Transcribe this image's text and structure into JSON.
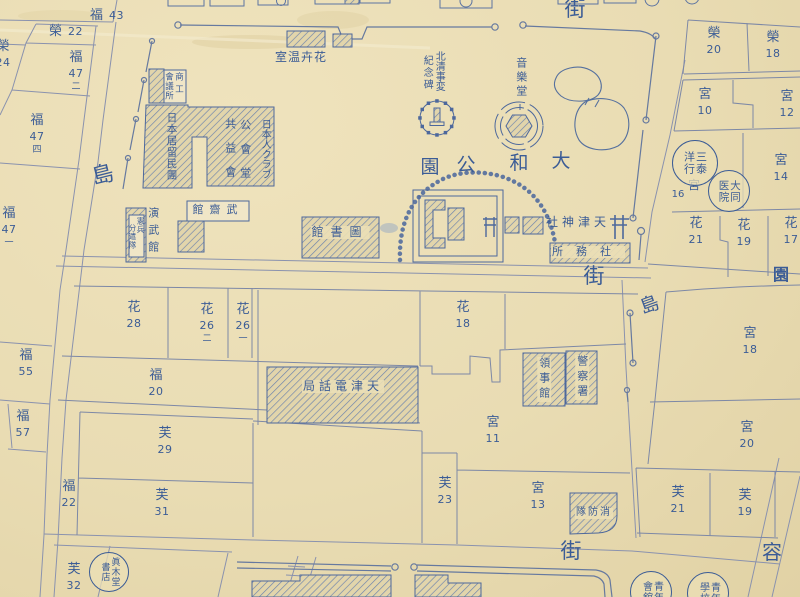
{
  "palette": {
    "paper": "#e9dcb3",
    "ink": "#3b5c96",
    "street_line": "#8a92ae",
    "block_line": "#7d88a6",
    "hatch": "#6b82ad"
  },
  "map": {
    "labels": [
      {
        "name": "street-gai-top",
        "text": "街",
        "x": 575,
        "y": -2,
        "size": 21
      },
      {
        "name": "street-shima-left",
        "text": "島",
        "x": 103,
        "y": 164,
        "size": 22,
        "rot": -14
      },
      {
        "name": "street-gai-middle",
        "text": "街",
        "x": 594,
        "y": 265,
        "size": 21
      },
      {
        "name": "street-shima-right",
        "text": "島",
        "x": 650,
        "y": 296,
        "size": 19,
        "rot": -20
      },
      {
        "name": "street-gai-bottom",
        "text": "街",
        "x": 571,
        "y": 540,
        "size": 21
      },
      {
        "name": "street-you",
        "text": "容",
        "x": 772,
        "y": 542,
        "size": 20
      },
      {
        "name": "street-en",
        "text": "園",
        "x": 781,
        "y": 267,
        "size": 16,
        "bold": true
      },
      {
        "name": "park-name-char-4",
        "text": "園",
        "x": 430,
        "y": 158,
        "size": 19
      },
      {
        "name": "park-name-char-3",
        "text": "公",
        "x": 466,
        "y": 156,
        "size": 19
      },
      {
        "name": "park-name-char-2",
        "text": "和",
        "x": 519,
        "y": 154,
        "size": 19
      },
      {
        "name": "park-name-char-1",
        "text": "大",
        "x": 561,
        "y": 152,
        "size": 19
      },
      {
        "name": "greenhouse-label",
        "text": "室温卉花",
        "x": 301,
        "y": 51,
        "size": 12,
        "sp": 1
      },
      {
        "name": "monument-label-right",
        "text": "北清事変",
        "x": 438,
        "y": 51,
        "size": 10,
        "dir": "v",
        "sp": 0
      },
      {
        "name": "monument-label-left",
        "text": "紀念碑",
        "x": 426,
        "y": 55,
        "size": 10,
        "dir": "v",
        "sp": 2
      },
      {
        "name": "music-hall-label",
        "text": "音樂堂",
        "x": 521,
        "y": 57,
        "size": 11,
        "dir": "v",
        "sp": 3
      },
      {
        "name": "shrine-label",
        "text": "社神津天",
        "x": 578,
        "y": 216,
        "size": 12,
        "sp": 4
      },
      {
        "name": "shrine-office-label",
        "text": "所務社",
        "x": 588,
        "y": 246,
        "size": 11,
        "sp": 13,
        "bg": true
      },
      {
        "name": "library-label",
        "text": "館書圖",
        "x": 340,
        "y": 226,
        "size": 12,
        "sp": 7,
        "bg": true
      },
      {
        "name": "telephone-office-label",
        "text": "局話電津天",
        "x": 343,
        "y": 380,
        "size": 12,
        "sp": 4,
        "bg": true
      },
      {
        "name": "chamber-label-right",
        "text": "商工",
        "x": 178,
        "y": 72,
        "size": 8.5,
        "dir": "v",
        "sp": 4
      },
      {
        "name": "chamber-label-left",
        "text": "會議所",
        "x": 168,
        "y": 72,
        "size": 8.5,
        "dir": "v",
        "sp": 1
      },
      {
        "name": "residents-association-label",
        "text": "日本居留民團",
        "x": 171,
        "y": 112,
        "size": 10.5,
        "dir": "v",
        "sp": 1
      },
      {
        "name": "kyoekikai-label",
        "text": "共益會",
        "x": 230,
        "y": 118,
        "size": 11,
        "dir": "v",
        "sp": 13
      },
      {
        "name": "kokaido-label",
        "text": "公會堂",
        "x": 245,
        "y": 119,
        "size": 11,
        "dir": "v",
        "sp": 13
      },
      {
        "name": "japanese-club-label",
        "text": "日本人クラブ",
        "x": 264,
        "y": 119,
        "size": 10,
        "dir": "v",
        "sp": 0
      },
      {
        "name": "buseikan-label",
        "text": "館齋武",
        "x": 218,
        "y": 204,
        "size": 11,
        "sp": 6
      },
      {
        "name": "enbukan-label",
        "text": "演武館",
        "x": 153,
        "y": 207,
        "size": 11,
        "dir": "v",
        "sp": 6
      },
      {
        "name": "kenpei-label-right",
        "text": "憲兵",
        "x": 140,
        "y": 217,
        "size": 7.5,
        "dir": "v",
        "sp": 1
      },
      {
        "name": "kenpei-label-left",
        "text": "分遣隊",
        "x": 132,
        "y": 224,
        "size": 7.5,
        "dir": "v",
        "sp": 1
      },
      {
        "name": "consulate-label",
        "text": "領事館",
        "x": 544,
        "y": 357,
        "size": 11,
        "dir": "v",
        "sp": 4,
        "bg": true
      },
      {
        "name": "police-label",
        "text": "警察署",
        "x": 582,
        "y": 355,
        "size": 11,
        "dir": "v",
        "sp": 4,
        "bg": true
      },
      {
        "name": "fire-brigade-label",
        "text": "隊防消",
        "x": 594,
        "y": 508,
        "size": 10,
        "sp": 2,
        "bg": true
      },
      {
        "name": "lot-miya-16-prefix",
        "text": "宮",
        "x": 694,
        "y": 179,
        "size": 12
      },
      {
        "name": "lot-miya-16-number",
        "text": "16",
        "x": 678,
        "y": 190,
        "size": 10
      }
    ],
    "lots": [
      {
        "name": "lot-fuku-43",
        "p": "福",
        "n": "43",
        "x": 107,
        "y": 9,
        "dir": "h"
      },
      {
        "name": "lot-sakae-22",
        "p": "榮",
        "n": "22",
        "x": 66,
        "y": 25,
        "dir": "h"
      },
      {
        "name": "lot-sakae-24",
        "p": "榮",
        "n": "24",
        "x": 3,
        "y": 40
      },
      {
        "name": "lot-fuku-47-2",
        "p": "福",
        "n": "47",
        "s": "二",
        "x": 76,
        "y": 51
      },
      {
        "name": "lot-fuku-47-4",
        "p": "福",
        "n": "47",
        "s": "四",
        "x": 37,
        "y": 114
      },
      {
        "name": "lot-fuku-47-1",
        "p": "福",
        "n": "47",
        "s": "一",
        "x": 9,
        "y": 207
      },
      {
        "name": "lot-fuku-55",
        "p": "福",
        "n": "55",
        "x": 26,
        "y": 349
      },
      {
        "name": "lot-fuku-57",
        "p": "福",
        "n": "57",
        "x": 23,
        "y": 410
      },
      {
        "name": "lot-fu-32",
        "p": "芙",
        "n": "32",
        "x": 74,
        "y": 563
      },
      {
        "name": "lot-hana-28",
        "p": "花",
        "n": "28",
        "x": 134,
        "y": 301
      },
      {
        "name": "lot-hana-26-2",
        "p": "花",
        "n": "26",
        "s": "二",
        "x": 207,
        "y": 303
      },
      {
        "name": "lot-hana-26-1",
        "p": "花",
        "n": "26",
        "s": "一",
        "x": 243,
        "y": 303
      },
      {
        "name": "lot-hana-18",
        "p": "花",
        "n": "18",
        "x": 463,
        "y": 301
      },
      {
        "name": "lot-fuku-20",
        "p": "福",
        "n": "20",
        "x": 156,
        "y": 369
      },
      {
        "name": "lot-miya-11",
        "p": "宮",
        "n": "11",
        "x": 493,
        "y": 416
      },
      {
        "name": "lot-fu-29",
        "p": "芙",
        "n": "29",
        "x": 165,
        "y": 427
      },
      {
        "name": "lot-fu-31",
        "p": "芙",
        "n": "31",
        "x": 162,
        "y": 489
      },
      {
        "name": "lot-fuku-22",
        "p": "福",
        "n": "22",
        "x": 69,
        "y": 480
      },
      {
        "name": "lot-fu-23",
        "p": "芙",
        "n": "23",
        "x": 445,
        "y": 477
      },
      {
        "name": "lot-miya-13",
        "p": "宮",
        "n": "13",
        "x": 538,
        "y": 482
      },
      {
        "name": "lot-fu-21",
        "p": "芙",
        "n": "21",
        "x": 678,
        "y": 486
      },
      {
        "name": "lot-fu-19",
        "p": "芙",
        "n": "19",
        "x": 745,
        "y": 489
      },
      {
        "name": "lot-miya-18",
        "p": "宮",
        "n": "18",
        "x": 750,
        "y": 327
      },
      {
        "name": "lot-miya-20",
        "p": "宮",
        "n": "20",
        "x": 747,
        "y": 421
      },
      {
        "name": "lot-sakae-20",
        "p": "榮",
        "n": "20",
        "x": 714,
        "y": 27
      },
      {
        "name": "lot-sakae-18",
        "p": "榮",
        "n": "18",
        "x": 773,
        "y": 31
      },
      {
        "name": "lot-miya-10",
        "p": "宮",
        "n": "10",
        "x": 705,
        "y": 88
      },
      {
        "name": "lot-miya-12",
        "p": "宮",
        "n": "12",
        "x": 787,
        "y": 90
      },
      {
        "name": "lot-miya-14",
        "p": "宮",
        "n": "14",
        "x": 781,
        "y": 154
      },
      {
        "name": "lot-hana-21",
        "p": "花",
        "n": "21",
        "x": 696,
        "y": 217
      },
      {
        "name": "lot-hana-19",
        "p": "花",
        "n": "19",
        "x": 744,
        "y": 219
      },
      {
        "name": "lot-hana-17",
        "p": "花",
        "n": "17",
        "x": 791,
        "y": 217
      }
    ],
    "seals": [
      {
        "name": "seal-makido-shoten",
        "right": "眞木堂",
        "left": "書店",
        "cx": 109,
        "cy": 572,
        "r": 20,
        "fs": 9
      },
      {
        "name": "seal-santai-yoko",
        "right": "三泰",
        "left": "洋行",
        "cx": 695,
        "cy": 163,
        "r": 23,
        "fs": 11
      },
      {
        "name": "seal-daido-hospital",
        "right": "大同",
        "left": "医院",
        "cx": 729,
        "cy": 191,
        "r": 21,
        "fs": 10.5
      },
      {
        "name": "seal-seinen-kaikan",
        "right": "青年",
        "left": "會舘",
        "cx": 651,
        "cy": 592,
        "r": 21,
        "fs": 10
      },
      {
        "name": "seal-seinen-gakko",
        "right": "青年",
        "left": "學校",
        "cx": 708,
        "cy": 593,
        "r": 21,
        "fs": 10
      }
    ]
  }
}
